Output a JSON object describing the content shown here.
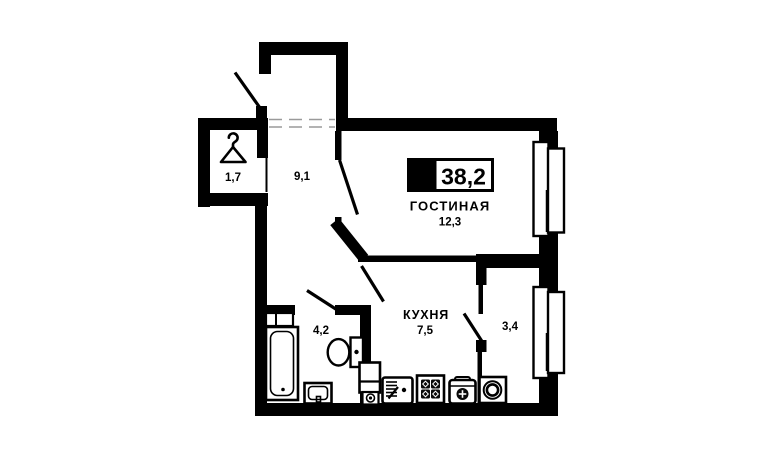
{
  "plan": {
    "badge": {
      "rooms": "1",
      "total_area": "38,2"
    },
    "rooms": [
      {
        "id": "wardrobe",
        "area": "1,7"
      },
      {
        "id": "hallway",
        "area": "9,1"
      },
      {
        "id": "living-room",
        "name": "ГОСТИНАЯ",
        "area": "12,3"
      },
      {
        "id": "bathroom",
        "area": "4,2"
      },
      {
        "id": "kitchen",
        "name": "КУХНЯ",
        "area": "7,5"
      },
      {
        "id": "loggia",
        "area": "3,4"
      }
    ],
    "colors": {
      "walls": "#000000",
      "background": "#ffffff",
      "dashed_line": "#9a9a9a"
    },
    "icons": [
      "hanger-icon",
      "bathtub-icon",
      "washbasin-icon",
      "toilet-icon",
      "shelf-icon",
      "cabinet-icon",
      "boiler-icon",
      "kitchen-sink-icon",
      "stove-icon",
      "water-heater-icon",
      "washing-machine-icon",
      "window-icon"
    ]
  }
}
